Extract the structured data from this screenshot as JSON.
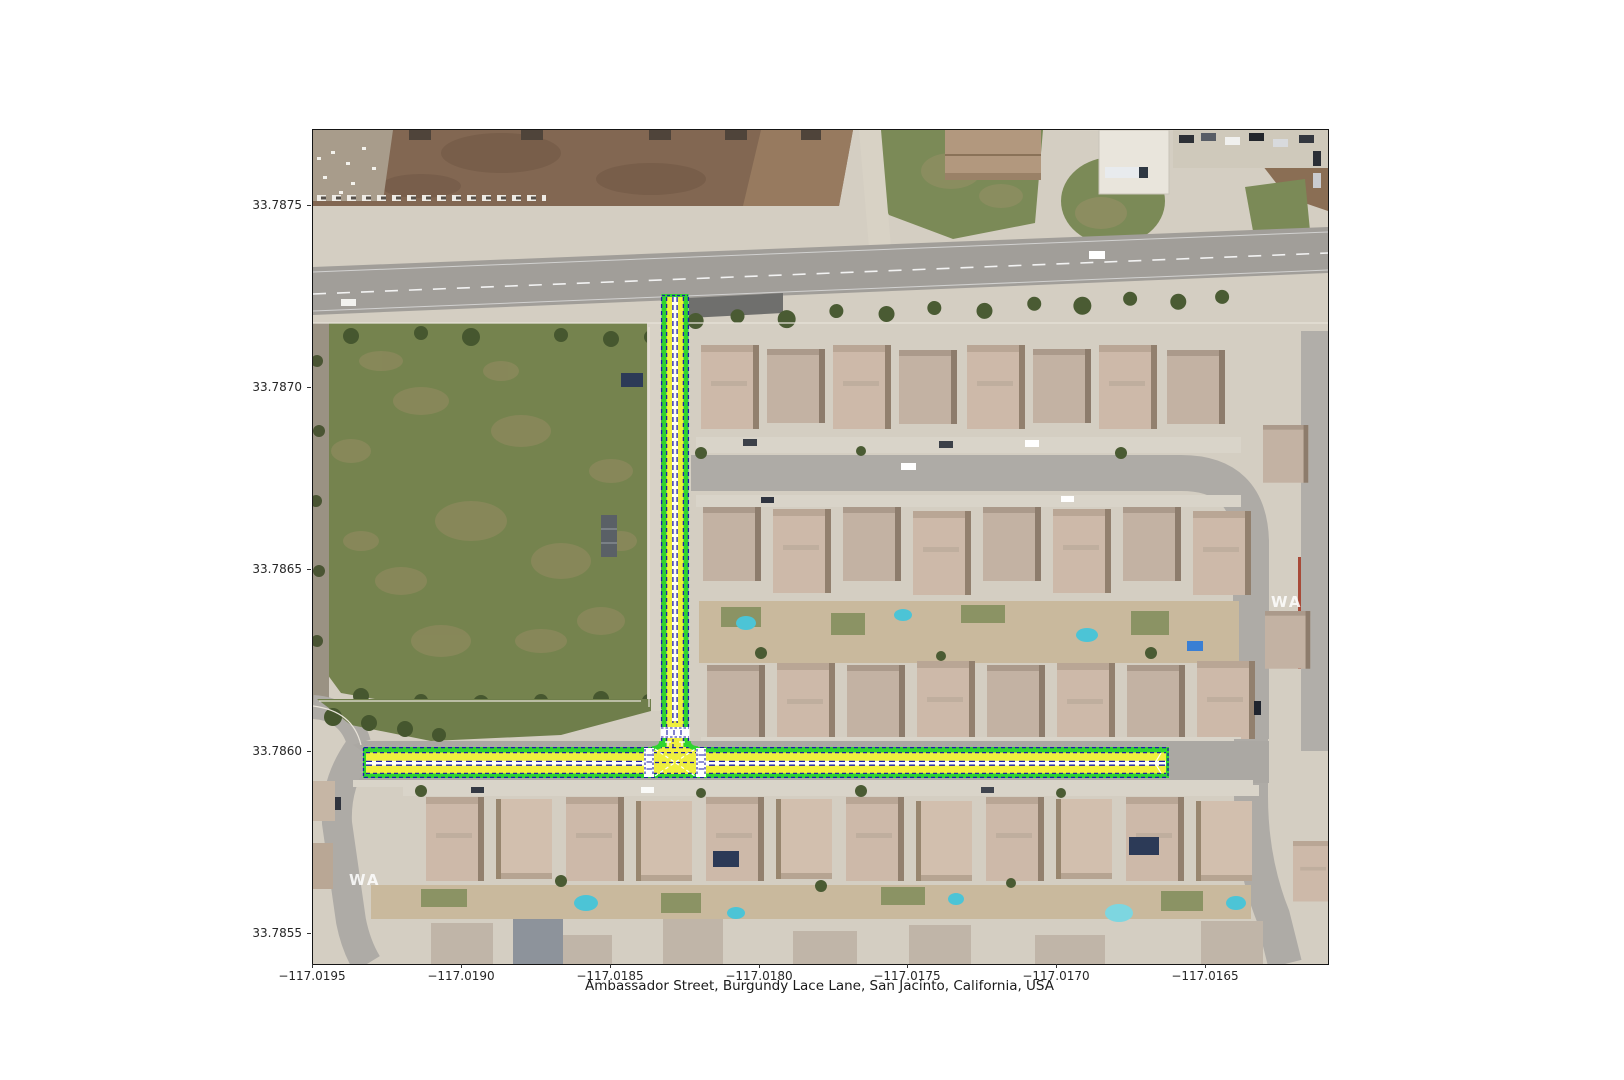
{
  "figure": {
    "caption": "Ambassador Street, Burgundy Lace Lane, San Jacinto, California, USA"
  },
  "map": {
    "type": "aerial-satellite-basemap-with-highlighted-lanes",
    "highlighted_streets": [
      "Ambassador Street",
      "Burgundy Lace Lane"
    ],
    "city": "San Jacinto",
    "state": "California",
    "country": "USA",
    "watermark": "WA"
  },
  "axes": {
    "x_ticks": [
      {
        "label": "−117.0195",
        "px": 312
      },
      {
        "label": "−117.0190",
        "px": 461
      },
      {
        "label": "−117.0185",
        "px": 610
      },
      {
        "label": "−117.0180",
        "px": 759
      },
      {
        "label": "−117.0175",
        "px": 907
      },
      {
        "label": "−117.0170",
        "px": 1056
      },
      {
        "label": "−117.0165",
        "px": 1205
      }
    ],
    "y_ticks": [
      {
        "label": "33.7875",
        "px": 205
      },
      {
        "label": "33.7870",
        "px": 387
      },
      {
        "label": "33.7865",
        "px": 569
      },
      {
        "label": "33.7860",
        "px": 751
      },
      {
        "label": "33.7855",
        "px": 933
      }
    ]
  },
  "colors": {
    "street_green": "#2fd42f",
    "lane_yellow": "#efef3e",
    "lane_line_navy": "#1d1daa",
    "crosswalk_white": "#ffffff",
    "figure_background": "#ffffff",
    "axis_text": "#262626"
  }
}
